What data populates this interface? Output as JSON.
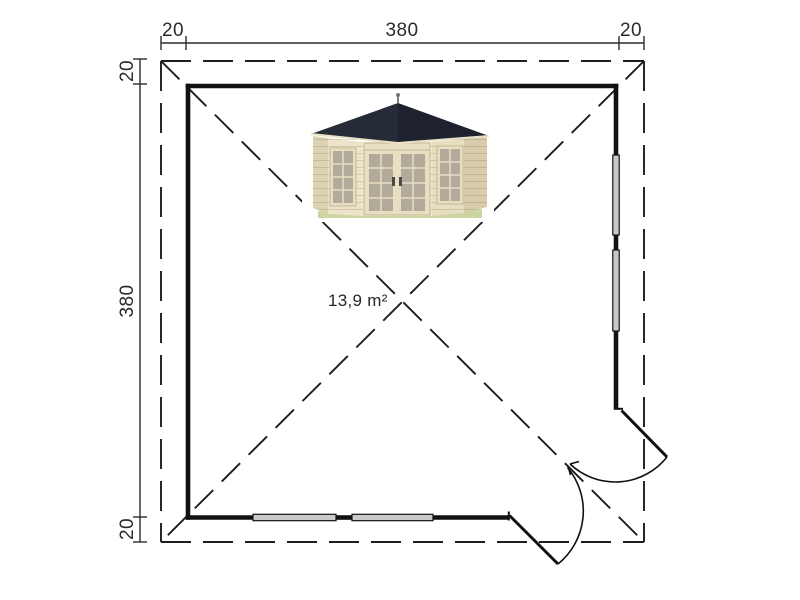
{
  "page": {
    "background": "#ffffff",
    "line_color": "#1d1d1d"
  },
  "dimensions": {
    "top": {
      "left_overhang": "20",
      "width": "380",
      "right_overhang": "20"
    },
    "left": {
      "top_overhang": "20",
      "height": "380",
      "bottom_overhang": "20"
    }
  },
  "plan": {
    "area_label": "13,9 m²",
    "features": {
      "right_wall_window_count": 2,
      "bottom_wall_window_count": 2,
      "door": "double corner door shown open with swing arcs",
      "roof_overhang": "dashed outline with crossed dashed diagonals"
    }
  },
  "house_photo": {
    "name": "corner log cabin with pyramid roof, double glazed doors and two windows",
    "colors": {
      "roof": "#222736",
      "walls": "#ece3c9",
      "glass": "#b2ab9c",
      "base": "#ccd49f"
    }
  }
}
